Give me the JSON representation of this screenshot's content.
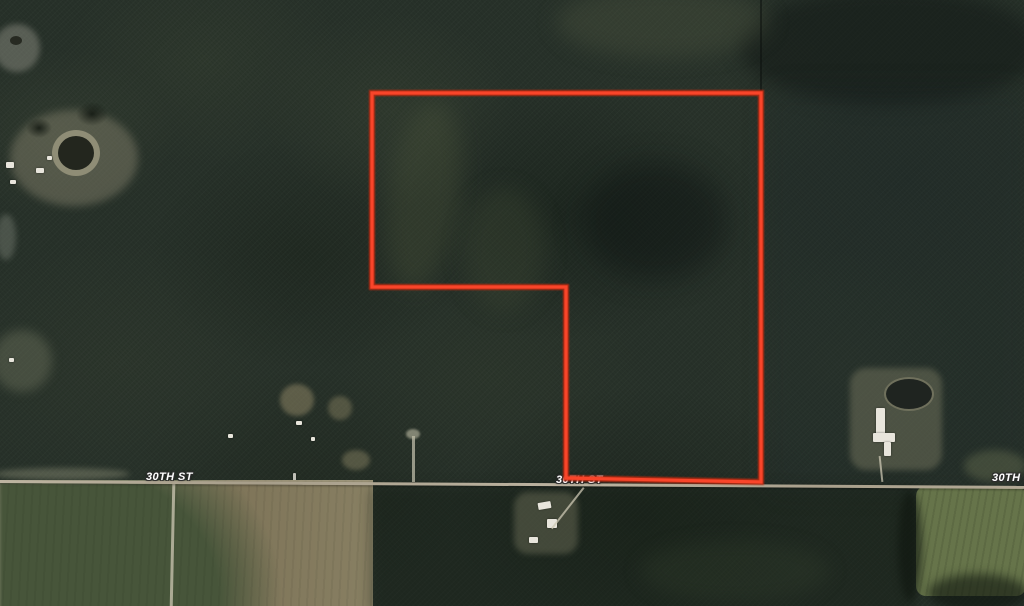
{
  "map": {
    "view": "aerial-satellite",
    "road": {
      "name": "30TH ST",
      "labels": [
        {
          "text": "30TH ST"
        },
        {
          "text": "30TH ST"
        },
        {
          "text": "30TH ST"
        }
      ]
    },
    "parcel_boundary": {
      "points": "372,93 761,93 761,482 566,478 566,287 372,287",
      "stroke_color": "#f9452a",
      "glow_color": "#c22a10",
      "stroke_width": 3.2,
      "glow_width": 6
    },
    "palette": {
      "forest_dark": "#232c25",
      "forest_light": "#4a543c",
      "field_tan": "#8c8468",
      "field_dark_green": "#47553a",
      "field_row_green": "#66744a",
      "road_surface": "#b9b09c",
      "pond_dark": "#23261e",
      "building_roof": "#e8e5dc",
      "label_text": "#ffffff"
    }
  }
}
